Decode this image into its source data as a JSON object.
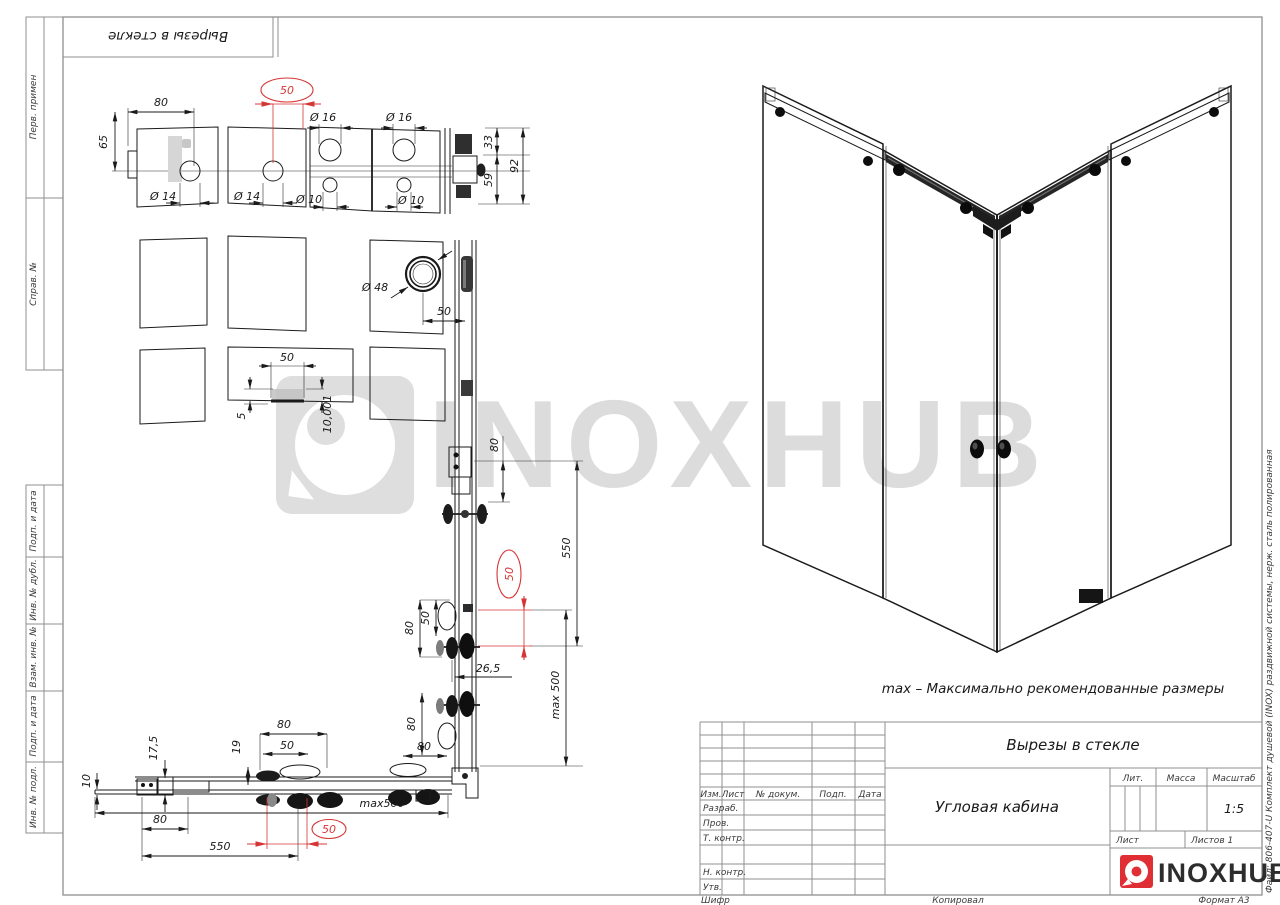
{
  "sheet": {
    "top_stamp_mirrored": "Вырезы в стекле",
    "margin_labels": [
      "Перв. примен",
      "Справ. №",
      "Подп. и дата",
      "Инв. № дубл.",
      "Взам. инв. №",
      "Подп. и дата",
      "Инв. № подл."
    ],
    "right_file_note": "Файл: 806-407-U Комплект душевой (INOX) раздвижной системы, нерж. сталь полированная",
    "footer": {
      "cipher": "Шифр",
      "copied": "Копировал",
      "format": "Формат А3"
    }
  },
  "watermark": {
    "brand": "INOXHUB"
  },
  "note_max": "max – Максимально рекомендованные размеры",
  "title_block": {
    "doc_title": "Вырезы в стекле",
    "product_name": "Угловая кабина",
    "header_cols": {
      "izm": "Изм.",
      "list": "Лист",
      "dokum": "№ докум.",
      "podp": "Подп.",
      "data": "Дата"
    },
    "sign_rows": {
      "razrab": "Разраб.",
      "prov": "Пров.",
      "tkontr": "Т. контр.",
      "nkontr": "Н. контр.",
      "utv": "Утв."
    },
    "lit_label": "Лит.",
    "massa_label": "Масса",
    "masshtab_label": "Масштаб",
    "scale_value": "1:5",
    "list_label": "Лист",
    "listov_label": "Листов 1",
    "brand": "INOXHUB",
    "accent_color": "#e02f34"
  },
  "dims": {
    "row1": {
      "w80": "80",
      "h65": "65",
      "d14_left": "Ø 14",
      "d14_mid": "Ø 14",
      "red50": "50",
      "d16_left": "Ø 16",
      "d16_right": "Ø 16",
      "d10_left": "Ø 10",
      "d10_right": "Ø 10",
      "h33": "33",
      "h59": "59",
      "h92": "92"
    },
    "row2": {
      "d48": "Ø 48",
      "w50": "50"
    },
    "row3": {
      "w50": "50",
      "d5": "5",
      "t10001": "10,001"
    },
    "column": {
      "t80": "80",
      "v550": "550",
      "red50": "50",
      "c80": "80",
      "c50": "50",
      "w265": "26,5",
      "vmax500": "max 500",
      "k80a": "80",
      "k80b": "80"
    },
    "bottom": {
      "v175": "17,5",
      "v10": "10",
      "w80": "80",
      "w550": "550",
      "g80": "80",
      "g50": "50",
      "v19": "19",
      "red50": "50",
      "hmax500": "max500"
    }
  }
}
